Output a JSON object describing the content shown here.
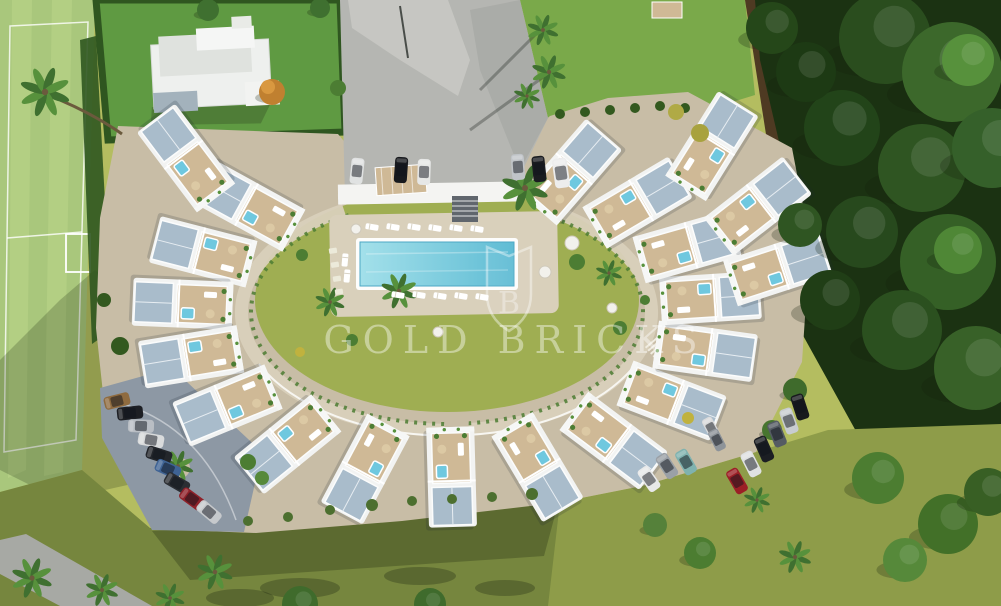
{
  "watermark": {
    "text": "GOLD BRICKS",
    "logo_letter": "B",
    "color": "#ffffff",
    "opacity": 0.4
  },
  "palette": {
    "grass": "#b4bd60",
    "grassOlive": "#8e9c49",
    "lawnBottom": "#76863e",
    "field": "#a9c77c",
    "fieldLight": "#bad489",
    "hedge": "#2f5620",
    "lawnGreen": "#5f9a42",
    "plaza": "#b5b6b2",
    "plazaLight": "#cbcbc5",
    "plazaShade": "#9fa19e",
    "lawnTR": "#7aa94a",
    "dirt": "#4e3a22",
    "forest": "#1b3212",
    "paveBeige": "#c8bda6",
    "paveBeigeLight": "#d9d0bb",
    "parking": "#8d98a4",
    "roofBlue": "#a9bccb",
    "deckTan": "#cfb996",
    "white": "#f4f5f4",
    "pool": "#8fd6e3",
    "poolDeep": "#5fbcd4",
    "jacuzzi": "#6fc8df",
    "courtLawn": "#9fae52",
    "shrub": "#4c7d33",
    "road": "#a7a9a4",
    "carRed": "#9b1f26"
  },
  "scene": {
    "description": "Aerial render: crescent apartment complex, central pool courtyard, rooftop terraces, sports field, parking, woodland",
    "building_ring": {
      "center": {
        "x": 447,
        "y": 315
      },
      "radius": {
        "x": 265,
        "y": 162
      },
      "angles": [
        222,
        203,
        184,
        165,
        146,
        127,
        108,
        89,
        70,
        51,
        32,
        13,
        -6,
        -25,
        -44,
        -62
      ],
      "extras": [
        {
          "x": 712,
          "y": 146,
          "rot": -58
        },
        {
          "x": 758,
          "y": 206,
          "rot": -38
        },
        {
          "x": 778,
          "y": 268,
          "rot": -18
        },
        {
          "x": 186,
          "y": 158,
          "rot": 233
        }
      ]
    },
    "pool": {
      "x": 360,
      "y": 242,
      "width": 154,
      "height": 44
    },
    "cars": {
      "left_row": [
        {
          "c": "#8f6b3f",
          "x": 117,
          "y": 401,
          "r": -14
        },
        {
          "c": "#1d1f24",
          "x": 130,
          "y": 413,
          "r": -6
        },
        {
          "c": "#b9bec4",
          "x": 141,
          "y": 426,
          "r": 2
        },
        {
          "c": "#d9dbdc",
          "x": 151,
          "y": 440,
          "r": 10
        },
        {
          "c": "#23262b",
          "x": 159,
          "y": 455,
          "r": 18
        },
        {
          "c": "#3f6394",
          "x": 168,
          "y": 469,
          "r": 24
        },
        {
          "c": "#2b2e33",
          "x": 177,
          "y": 483,
          "r": 30
        },
        {
          "c": "#8f2129",
          "x": 192,
          "y": 499,
          "r": 36
        },
        {
          "c": "#c6c9cc",
          "x": 209,
          "y": 512,
          "r": 40
        }
      ],
      "top_row": [
        {
          "c": "#e0e2e2",
          "x": 357,
          "y": 171,
          "r": 96
        },
        {
          "c": "#17191d",
          "x": 401,
          "y": 170,
          "r": 94
        },
        {
          "c": "#e6e7e6",
          "x": 424,
          "y": 172,
          "r": 92
        },
        {
          "c": "#c0c4c8",
          "x": 518,
          "y": 167,
          "r": 86
        },
        {
          "c": "#1a1c20",
          "x": 539,
          "y": 169,
          "r": 84
        },
        {
          "c": "#ededed",
          "x": 561,
          "y": 173,
          "r": 82,
          "s": 1.15
        }
      ],
      "right_row": [
        {
          "c": "#17191d",
          "x": 800,
          "y": 407,
          "r": 72
        },
        {
          "c": "#c8ccd0",
          "x": 789,
          "y": 421,
          "r": 70
        },
        {
          "c": "#555b63",
          "x": 777,
          "y": 434,
          "r": 68
        },
        {
          "c": "#1b1e23",
          "x": 764,
          "y": 449,
          "r": 66
        },
        {
          "c": "#dfe1e2",
          "x": 751,
          "y": 464,
          "r": 63
        },
        {
          "c": "#9b1f26",
          "x": 737,
          "y": 481,
          "r": 60
        }
      ],
      "inner": [
        {
          "c": "#e8e9e9",
          "x": 649,
          "y": 479,
          "r": 55
        },
        {
          "c": "#9aa0a6",
          "x": 667,
          "y": 466,
          "r": 57
        },
        {
          "c": "#7fb2af",
          "x": 686,
          "y": 462,
          "r": 60
        },
        {
          "c": "#d9dadb",
          "x": 711,
          "y": 428,
          "r": 62,
          "s": 0.85
        },
        {
          "c": "#8d9399",
          "x": 717,
          "y": 440,
          "r": 63,
          "s": 0.85
        }
      ]
    },
    "palms": [
      {
        "x": 45,
        "y": 92,
        "s": 1.6
      },
      {
        "x": 543,
        "y": 30,
        "s": 1.0
      },
      {
        "x": 549,
        "y": 72,
        "s": 1.1
      },
      {
        "x": 527,
        "y": 96,
        "s": 0.85
      },
      {
        "x": 525,
        "y": 188,
        "s": 1.5
      },
      {
        "x": 399,
        "y": 291,
        "s": 1.15
      },
      {
        "x": 330,
        "y": 302,
        "s": 0.95
      },
      {
        "x": 609,
        "y": 273,
        "s": 0.85
      },
      {
        "x": 178,
        "y": 466,
        "s": 1.0
      },
      {
        "x": 32,
        "y": 578,
        "s": 1.3
      },
      {
        "x": 102,
        "y": 590,
        "s": 1.05
      },
      {
        "x": 170,
        "y": 598,
        "s": 0.95
      },
      {
        "x": 215,
        "y": 572,
        "s": 1.15
      },
      {
        "x": 795,
        "y": 557,
        "s": 1.05
      },
      {
        "x": 757,
        "y": 500,
        "s": 0.85
      }
    ],
    "trees": [
      {
        "x": 885,
        "y": 38,
        "r": 46,
        "c": "#2a4d1e"
      },
      {
        "x": 952,
        "y": 72,
        "r": 50,
        "c": "#3c682b"
      },
      {
        "x": 968,
        "y": 60,
        "r": 26,
        "c": "#57913c"
      },
      {
        "x": 842,
        "y": 128,
        "r": 38,
        "c": "#224419"
      },
      {
        "x": 922,
        "y": 168,
        "r": 44,
        "c": "#2f5522"
      },
      {
        "x": 992,
        "y": 148,
        "r": 40,
        "c": "#35602a"
      },
      {
        "x": 862,
        "y": 232,
        "r": 36,
        "c": "#27491d"
      },
      {
        "x": 948,
        "y": 262,
        "r": 48,
        "c": "#356026"
      },
      {
        "x": 958,
        "y": 250,
        "r": 24,
        "c": "#4f8736"
      },
      {
        "x": 902,
        "y": 330,
        "r": 40,
        "c": "#2b501f"
      },
      {
        "x": 976,
        "y": 368,
        "r": 42,
        "c": "#386128"
      },
      {
        "x": 830,
        "y": 300,
        "r": 30,
        "c": "#203e16"
      },
      {
        "x": 806,
        "y": 72,
        "r": 30,
        "c": "#1d3a14"
      },
      {
        "x": 772,
        "y": 28,
        "r": 26,
        "c": "#254719"
      },
      {
        "x": 800,
        "y": 225,
        "r": 22,
        "c": "#2f5522"
      },
      {
        "x": 560,
        "y": 114,
        "r": 5,
        "c": "#33591f"
      },
      {
        "x": 585,
        "y": 112,
        "r": 5,
        "c": "#33591f"
      },
      {
        "x": 610,
        "y": 110,
        "r": 5,
        "c": "#33591f"
      },
      {
        "x": 635,
        "y": 108,
        "r": 5,
        "c": "#33591f"
      },
      {
        "x": 660,
        "y": 106,
        "r": 5,
        "c": "#33591f"
      },
      {
        "x": 685,
        "y": 108,
        "r": 5,
        "c": "#33591f"
      },
      {
        "x": 208,
        "y": 10,
        "r": 11,
        "c": "#3f7030"
      },
      {
        "x": 320,
        "y": 8,
        "r": 10,
        "c": "#3f7030"
      },
      {
        "x": 338,
        "y": 88,
        "r": 8,
        "c": "#4c7d33"
      },
      {
        "x": 272,
        "y": 92,
        "r": 13,
        "c": "#c08030"
      },
      {
        "x": 268,
        "y": 87,
        "r": 7,
        "c": "#d99840"
      },
      {
        "x": 878,
        "y": 478,
        "r": 26,
        "c": "#4c7d31"
      },
      {
        "x": 948,
        "y": 524,
        "r": 30,
        "c": "#427028"
      },
      {
        "x": 905,
        "y": 560,
        "r": 22,
        "c": "#56893a"
      },
      {
        "x": 988,
        "y": 492,
        "r": 24,
        "c": "#385f24"
      },
      {
        "x": 700,
        "y": 553,
        "r": 16,
        "c": "#4c7d31"
      },
      {
        "x": 655,
        "y": 525,
        "r": 12,
        "c": "#55813a"
      },
      {
        "x": 300,
        "y": 604,
        "r": 18,
        "c": "#3f6b2c"
      },
      {
        "x": 430,
        "y": 604,
        "r": 16,
        "c": "#3f6b2c"
      },
      {
        "x": 700,
        "y": 133,
        "r": 9,
        "c": "#a8a23e"
      },
      {
        "x": 676,
        "y": 112,
        "r": 8,
        "c": "#b0aa45"
      },
      {
        "x": 795,
        "y": 390,
        "r": 12,
        "c": "#3f6b2c"
      },
      {
        "x": 772,
        "y": 430,
        "r": 10,
        "c": "#47752f"
      },
      {
        "x": 372,
        "y": 505,
        "r": 6,
        "c": "#4c6f2f"
      },
      {
        "x": 412,
        "y": 501,
        "r": 5,
        "c": "#4c6f2f"
      },
      {
        "x": 452,
        "y": 499,
        "r": 5,
        "c": "#4c6f2f"
      },
      {
        "x": 492,
        "y": 497,
        "r": 5,
        "c": "#4c6f2f"
      },
      {
        "x": 532,
        "y": 494,
        "r": 6,
        "c": "#4c6f2f"
      },
      {
        "x": 330,
        "y": 510,
        "r": 5,
        "c": "#4c6f2f"
      },
      {
        "x": 288,
        "y": 517,
        "r": 5,
        "c": "#4c6f2f"
      },
      {
        "x": 248,
        "y": 521,
        "r": 5,
        "c": "#4c6f2f"
      },
      {
        "x": 577,
        "y": 262,
        "r": 8,
        "c": "#4c7d33"
      },
      {
        "x": 620,
        "y": 328,
        "r": 7,
        "c": "#4c7d33"
      },
      {
        "x": 352,
        "y": 340,
        "r": 6,
        "c": "#4c7d33"
      },
      {
        "x": 302,
        "y": 255,
        "r": 6,
        "c": "#4c7d33"
      },
      {
        "x": 300,
        "y": 352,
        "r": 5,
        "c": "#c0b23e"
      },
      {
        "x": 688,
        "y": 418,
        "r": 6,
        "c": "#c0b23e"
      },
      {
        "x": 645,
        "y": 300,
        "r": 5,
        "c": "#4c7d33"
      },
      {
        "x": 248,
        "y": 462,
        "r": 8,
        "c": "#4c7d33"
      },
      {
        "x": 262,
        "y": 478,
        "r": 7,
        "c": "#56893a"
      },
      {
        "x": 120,
        "y": 346,
        "r": 9,
        "c": "#33591f"
      },
      {
        "x": 104,
        "y": 300,
        "r": 7,
        "c": "#33591f"
      }
    ],
    "round_tables": [
      {
        "x": 572,
        "y": 243,
        "r": 7
      },
      {
        "x": 545,
        "y": 272,
        "r": 6
      },
      {
        "x": 612,
        "y": 308,
        "r": 5
      },
      {
        "x": 438,
        "y": 332,
        "r": 5
      },
      {
        "x": 356,
        "y": 229,
        "r": 5
      }
    ],
    "loungers": [
      {
        "x": 372,
        "y": 227,
        "r": 9
      },
      {
        "x": 393,
        "y": 227,
        "r": 9
      },
      {
        "x": 414,
        "y": 227,
        "r": 9
      },
      {
        "x": 435,
        "y": 228,
        "r": 9
      },
      {
        "x": 456,
        "y": 228,
        "r": 9
      },
      {
        "x": 477,
        "y": 229,
        "r": 9
      },
      {
        "x": 398,
        "y": 295,
        "r": 9
      },
      {
        "x": 419,
        "y": 295,
        "r": 9
      },
      {
        "x": 440,
        "y": 296,
        "r": 9
      },
      {
        "x": 461,
        "y": 296,
        "r": 9
      },
      {
        "x": 482,
        "y": 297,
        "r": 9
      },
      {
        "x": 345,
        "y": 260,
        "r": 95
      },
      {
        "x": 347,
        "y": 276,
        "r": 95
      }
    ],
    "stones": [
      {
        "x": 333,
        "y": 251
      },
      {
        "x": 335,
        "y": 265
      },
      {
        "x": 337,
        "y": 279
      },
      {
        "x": 339,
        "y": 292
      }
    ]
  }
}
